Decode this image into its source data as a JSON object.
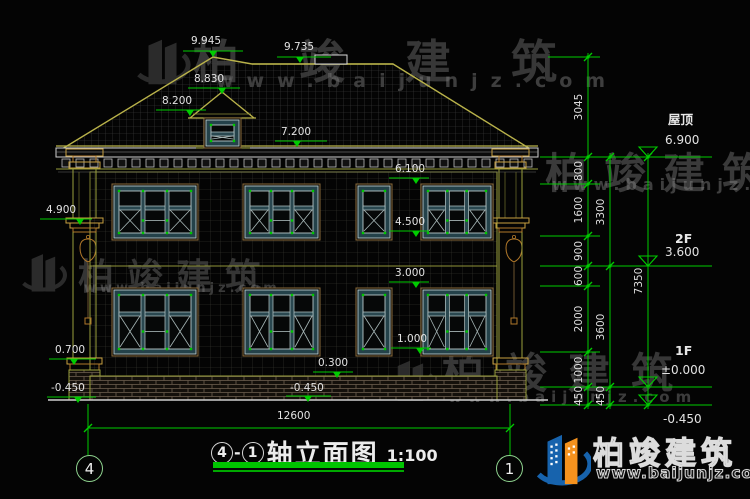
{
  "title": {
    "axis_start": "4",
    "separator": "-",
    "axis_end": "1",
    "name": "轴立面图",
    "scale": "1:100"
  },
  "grid_bubbles": {
    "left": "4",
    "right": "1"
  },
  "bottom_dimension": {
    "text": "12600",
    "x": 277,
    "y": 411,
    "x1": 88,
    "x2": 510,
    "line_y": 428
  },
  "watermark": {
    "name": "柏竣建筑",
    "url": "www.baijunjz.com"
  },
  "logo": {
    "name": "柏竣建筑",
    "url": "www.baijunjz.com",
    "blue": "#1763ad",
    "orange": "#f5921e"
  },
  "colors": {
    "dim_green": "#00cc00",
    "cad_text": "#e3e3e3",
    "outline_olive": "#9aa03c",
    "roof_edge": "#b9b24a",
    "window_frame": "#24424a",
    "ornament_brown": "#b0782a"
  },
  "elevation_flags": [
    {
      "text": "9.945",
      "tx": 191,
      "ty": 36,
      "x1": 183,
      "x2": 243,
      "ly": 51,
      "ax": 213
    },
    {
      "text": "9.735",
      "tx": 284,
      "ty": 42,
      "x1": 277,
      "x2": 331,
      "ly": 57,
      "ax": 300
    },
    {
      "text": "8.830",
      "tx": 194,
      "ty": 74,
      "x1": 188,
      "x2": 240,
      "ly": 88,
      "ax": 222
    },
    {
      "text": "8.200",
      "tx": 162,
      "ty": 96,
      "x1": 156,
      "x2": 206,
      "ly": 110,
      "ax": 190
    },
    {
      "text": "7.200",
      "tx": 281,
      "ty": 127,
      "x1": 275,
      "x2": 327,
      "ly": 141,
      "ax": 297
    },
    {
      "text": "6.100",
      "tx": 395,
      "ty": 164,
      "x1": 389,
      "x2": 429,
      "ly": 178,
      "ax": 416
    },
    {
      "text": "4.500",
      "tx": 395,
      "ty": 217,
      "x1": 389,
      "x2": 429,
      "ly": 231,
      "ax": 416
    },
    {
      "text": "3.000",
      "tx": 395,
      "ty": 268,
      "x1": 389,
      "x2": 429,
      "ly": 282,
      "ax": 416
    },
    {
      "text": "1.000",
      "tx": 397,
      "ty": 334,
      "x1": 391,
      "x2": 431,
      "ly": 348,
      "ax": 420
    },
    {
      "text": "0.300",
      "tx": 318,
      "ty": 358,
      "x1": 313,
      "x2": 353,
      "ly": 372,
      "ax": 337
    },
    {
      "text": "-0.450",
      "tx": 290,
      "ty": 383,
      "x1": 286,
      "x2": 331,
      "ly": 396,
      "ax": 308
    },
    {
      "text": "4.900",
      "tx": 46,
      "ty": 205,
      "x1": 40,
      "x2": 92,
      "ly": 219,
      "ax": 80
    },
    {
      "text": "0.700",
      "tx": 55,
      "ty": 345,
      "x1": 49,
      "x2": 96,
      "ly": 359,
      "ax": 74
    },
    {
      "text": "-0.450",
      "tx": 51,
      "ty": 383,
      "x1": 47,
      "x2": 96,
      "ly": 397,
      "ax": 78
    }
  ],
  "right_levels": [
    {
      "label": "屋顶",
      "value": "6.900",
      "y": 157,
      "label_x": 668,
      "label_y": 109,
      "value_x": 665,
      "value_y": 133,
      "below": false
    },
    {
      "label": "2F",
      "value": "3.600",
      "y": 266,
      "label_x": 675,
      "label_y": 231,
      "value_x": 665,
      "value_y": 245,
      "below": false
    },
    {
      "label": "1F",
      "value": "±0.000",
      "y": 387,
      "label_x": 675,
      "label_y": 343,
      "value_x": 661,
      "value_y": 363,
      "below": false
    },
    {
      "label": "",
      "value": "-0.450",
      "y": 405,
      "label_x": 0,
      "label_y": 0,
      "value_x": 663,
      "value_y": 412,
      "below": true
    }
  ],
  "dim_chains": {
    "inner": {
      "x": 588,
      "y_top": 57,
      "y_bot": 405,
      "ticks": [
        57,
        157,
        184,
        236,
        266,
        286,
        352,
        387,
        405
      ],
      "labels": [
        {
          "v": "3045",
          "y": 107
        },
        {
          "v": "800",
          "y": 171
        },
        {
          "v": "1600",
          "y": 210
        },
        {
          "v": "900",
          "y": 251
        },
        {
          "v": "600",
          "y": 276
        },
        {
          "v": "2000",
          "y": 319
        },
        {
          "v": "1000",
          "y": 370
        },
        {
          "v": "450",
          "y": 396
        }
      ]
    },
    "middle": {
      "x": 610,
      "y_top": 157,
      "y_bot": 405,
      "ticks": [
        157,
        266,
        387,
        405
      ],
      "labels": [
        {
          "v": "3300",
          "y": 212
        },
        {
          "v": "3600",
          "y": 327
        },
        {
          "v": "450",
          "y": 396
        }
      ]
    },
    "outer": {
      "x": 648,
      "y_top": 157,
      "y_bot": 405,
      "ticks": [
        157,
        405
      ],
      "labels": [
        {
          "v": "7350",
          "y": 281
        }
      ]
    }
  },
  "extension_lines": [
    {
      "y": 57,
      "x1": 548,
      "x2": 600
    },
    {
      "y": 157,
      "x1": 540,
      "x2": 712
    },
    {
      "y": 184,
      "x1": 540,
      "x2": 600
    },
    {
      "y": 236,
      "x1": 540,
      "x2": 600
    },
    {
      "y": 266,
      "x1": 540,
      "x2": 712
    },
    {
      "y": 286,
      "x1": 540,
      "x2": 600
    },
    {
      "y": 352,
      "x1": 540,
      "x2": 600
    },
    {
      "y": 387,
      "x1": 540,
      "x2": 712
    },
    {
      "y": 405,
      "x1": 540,
      "x2": 712
    }
  ]
}
